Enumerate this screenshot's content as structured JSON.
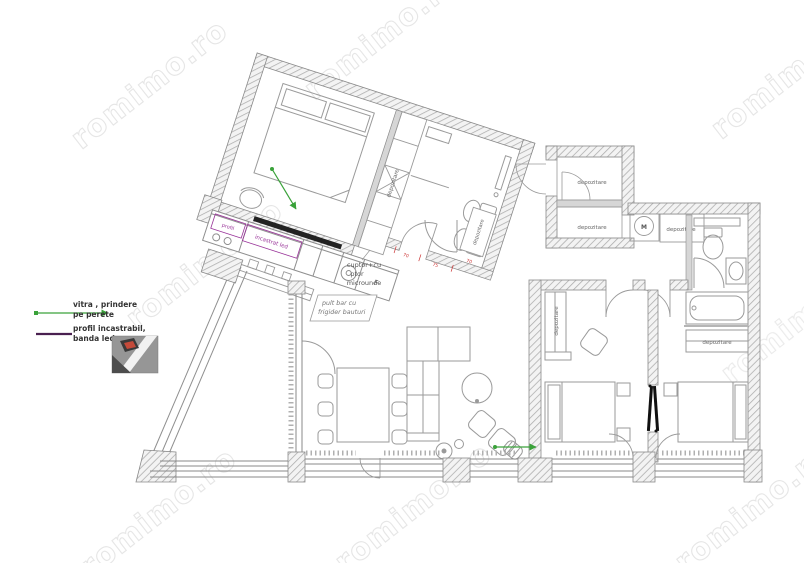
{
  "watermark": {
    "text": "romimo.ro",
    "color": "#e2e2e2"
  },
  "legend": {
    "vitra_line1": "vitra ,  prindere",
    "vitra_line2": "pe perete",
    "profil_line1": "profil incastrabil,",
    "profil_line2": "banda led",
    "vitra_color": "#3aa23a",
    "profil_color": "#4a2050"
  },
  "plan": {
    "storage_label": "depozitare",
    "kitchen": {
      "profil_short": "profil",
      "incastrat": "incastrat led",
      "oven_line1": "cuptor+cu",
      "oven_line2": "ptor",
      "oven_line3": "microunde",
      "fridge": "F",
      "led_text_color": "#993399"
    },
    "bar": {
      "line1": "pult bar cu",
      "line2": "frigider bauturi"
    },
    "washer_icon": "M",
    "dims": {
      "d1": "70",
      "d2": "75",
      "d3": "70",
      "color": "#cc3333"
    }
  }
}
